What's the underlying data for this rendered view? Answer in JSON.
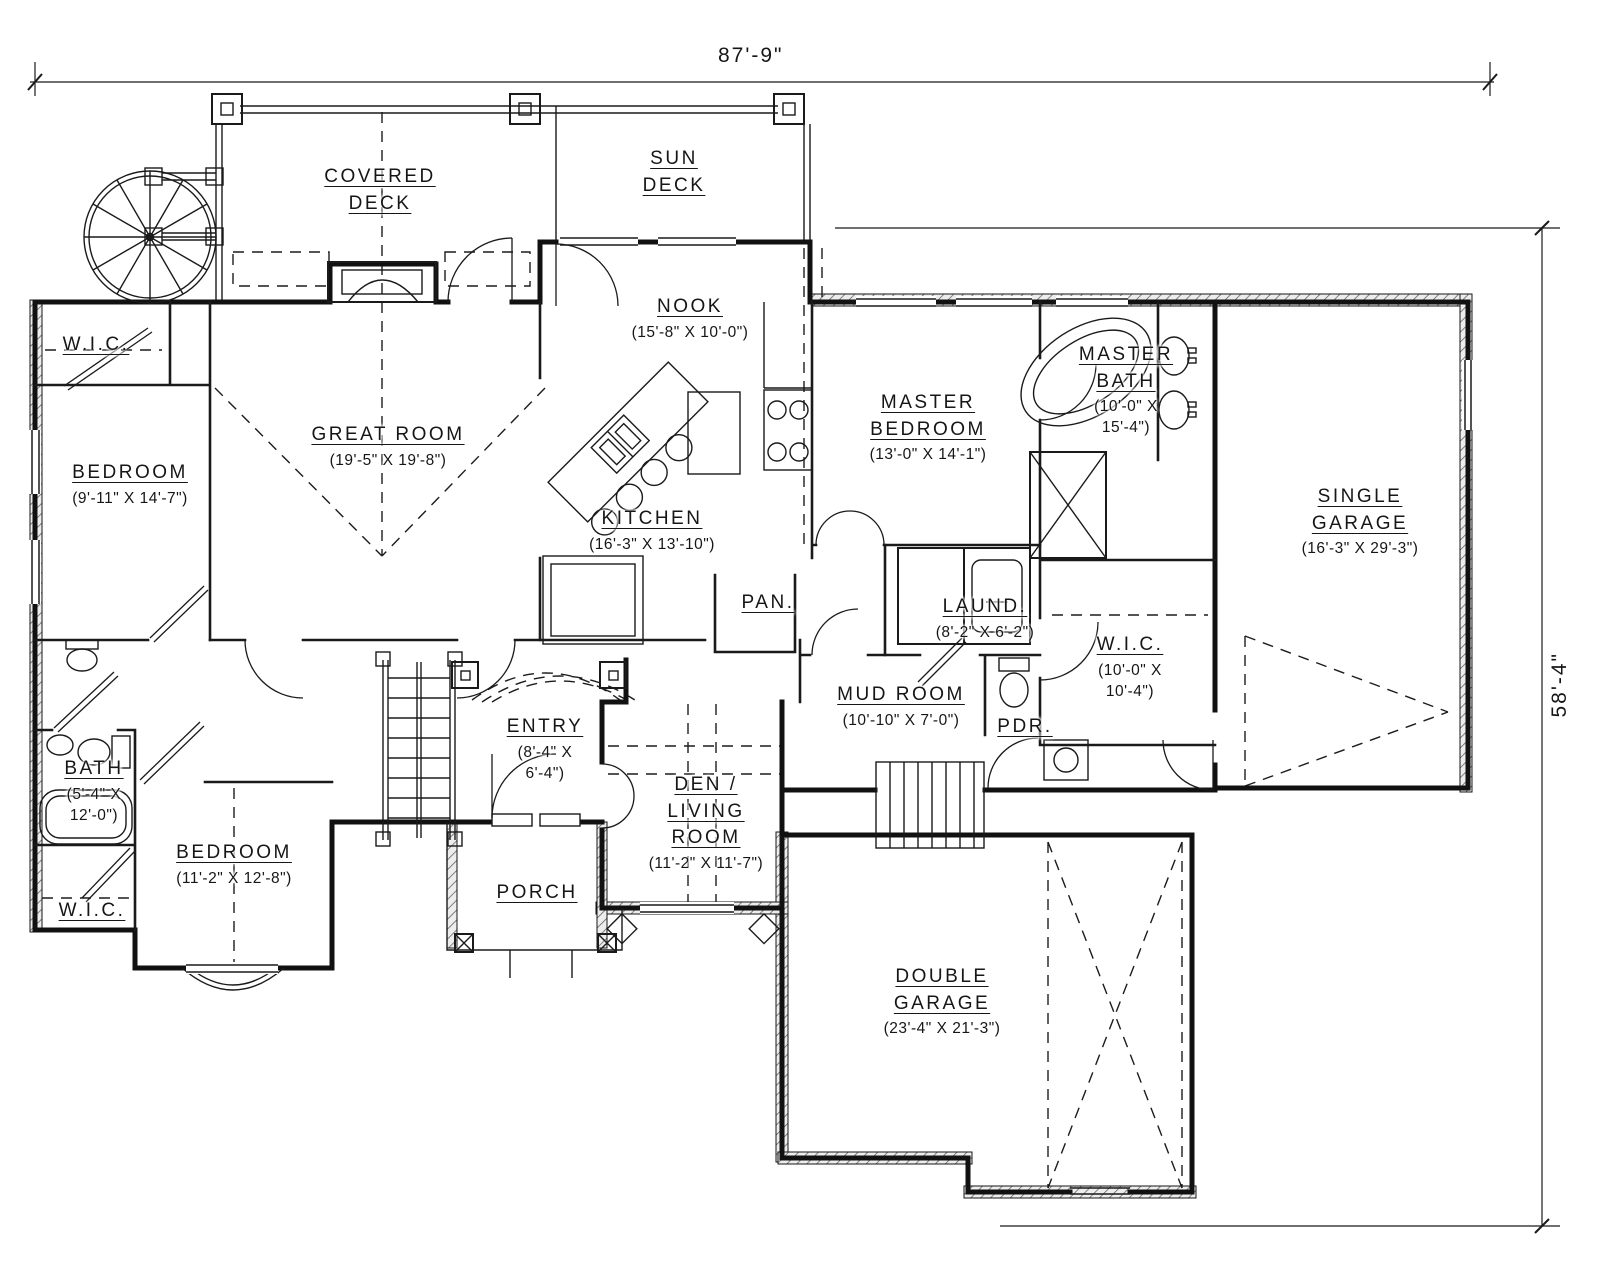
{
  "drawing": {
    "type_label": "Main Floor Plan"
  },
  "dimensions": {
    "overall_width": "87'-9\"",
    "overall_height": "58'-4\""
  },
  "rooms": {
    "covered_deck": {
      "label": "COVERED\nDECK",
      "dim": ""
    },
    "sun_deck": {
      "label": "SUN\nDECK",
      "dim": ""
    },
    "nook": {
      "label": "NOOK",
      "dim": "(15'-8\" X 10'-0\")"
    },
    "great_room": {
      "label": "GREAT ROOM",
      "dim": "(19'-5\" X 19'-8\")"
    },
    "kitchen": {
      "label": "KITCHEN",
      "dim": "(16'-3\" X 13'-10\")"
    },
    "master_bedroom": {
      "label": "MASTER\nBEDROOM",
      "dim": "(13'-0\" X 14'-1\")"
    },
    "master_bath": {
      "label": "MASTER\nBATH",
      "dim": "(10'-0\" X\n15'-4\")"
    },
    "wic_upper": {
      "label": "W.I.C.",
      "dim": ""
    },
    "bedroom_left": {
      "label": "BEDROOM",
      "dim": "(9'-11\" X 14'-7\")"
    },
    "single_garage": {
      "label": "SINGLE\nGARAGE",
      "dim": "(16'-3\" X 29'-3\")"
    },
    "pantry": {
      "label": "PAN.",
      "dim": ""
    },
    "laundry": {
      "label": "LAUND.",
      "dim": "(8'-2\" X 6'-2\")"
    },
    "wic_master": {
      "label": "W.I.C.",
      "dim": "(10'-0\" X\n10'-4\")"
    },
    "mud_room": {
      "label": "MUD ROOM",
      "dim": "(10'-10\" X 7'-0\")"
    },
    "powder": {
      "label": "PDR.",
      "dim": ""
    },
    "entry": {
      "label": "ENTRY",
      "dim": "(8'-4\" X\n6'-4\")"
    },
    "bath": {
      "label": "BATH",
      "dim": "(5'-4\" X\n12'-0\")"
    },
    "bedroom_lower": {
      "label": "BEDROOM",
      "dim": "(11'-2\" X 12'-8\")"
    },
    "wic_lower": {
      "label": "W.I.C.",
      "dim": ""
    },
    "porch": {
      "label": "PORCH",
      "dim": ""
    },
    "den": {
      "label": "DEN /\nLIVING\nROOM",
      "dim": "(11'-2\" X 11'-7\")"
    },
    "double_garage": {
      "label": "DOUBLE\nGARAGE",
      "dim": "(23'-4\" X 21'-3\")"
    }
  }
}
